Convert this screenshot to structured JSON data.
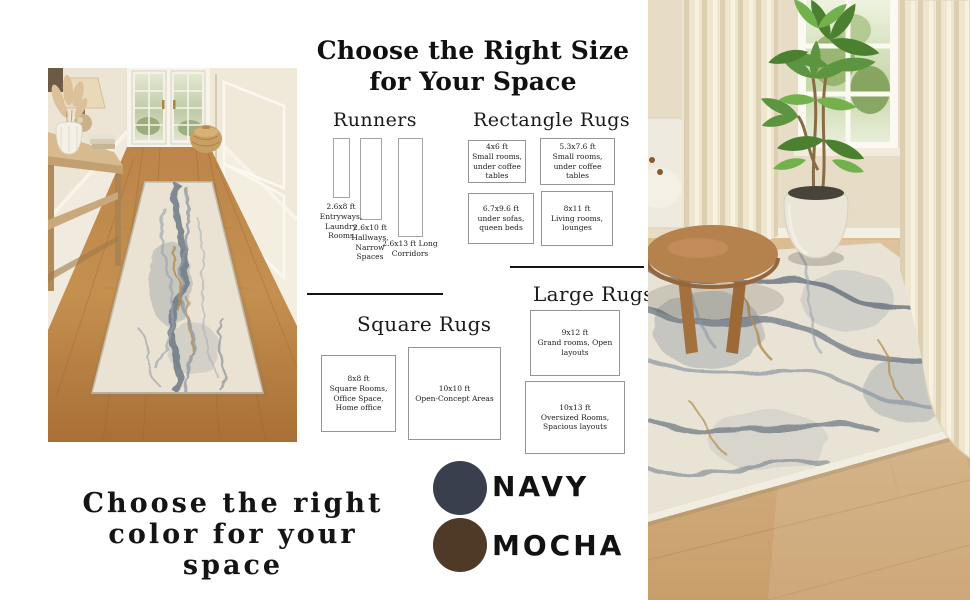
{
  "size_guide": {
    "title_line1": "Choose the Right Size",
    "title_line2": "for Your Space",
    "runners": {
      "heading": "Runners",
      "items": [
        {
          "size": "2.6x8 ft",
          "use": "Entryways, Laundry Rooms"
        },
        {
          "size": "2.6x10 ft",
          "use": "Hallways, Narrow Spaces"
        },
        {
          "size": "2.6x13 ft",
          "use": "Long Corridors"
        }
      ]
    },
    "rectangle": {
      "heading": "Rectangle Rugs",
      "items": [
        {
          "size": "4x6 ft",
          "use": "Small rooms, under coffee tables"
        },
        {
          "size": "5.3x7.6 ft",
          "use": "Small rooms, under coffee tables"
        },
        {
          "size": "6.7x9.6 ft",
          "use": "under sofas, queen beds"
        },
        {
          "size": "8x11 ft",
          "use": "Living rooms, lounges"
        }
      ]
    },
    "square": {
      "heading": "Square Rugs",
      "items": [
        {
          "size": "8x8 ft",
          "use": "Square Rooms, Office Space, Home office"
        },
        {
          "size": "10x10 ft",
          "use": "Open-Concept Areas"
        }
      ]
    },
    "large": {
      "heading": "Large Rugs",
      "items": [
        {
          "size": "9x12 ft",
          "use": "Grand rooms, Open layouts"
        },
        {
          "size": "10x13 ft",
          "use": "Oversized Rooms, Spacious layouts"
        }
      ]
    }
  },
  "color_guide": {
    "heading_line1": "Choose the right",
    "heading_line2": "color for your",
    "heading_line3": "space",
    "swatches": [
      {
        "name": "NAVY",
        "hex": "#3a3f4e"
      },
      {
        "name": "MOCHA",
        "hex": "#4f3a28"
      }
    ]
  }
}
